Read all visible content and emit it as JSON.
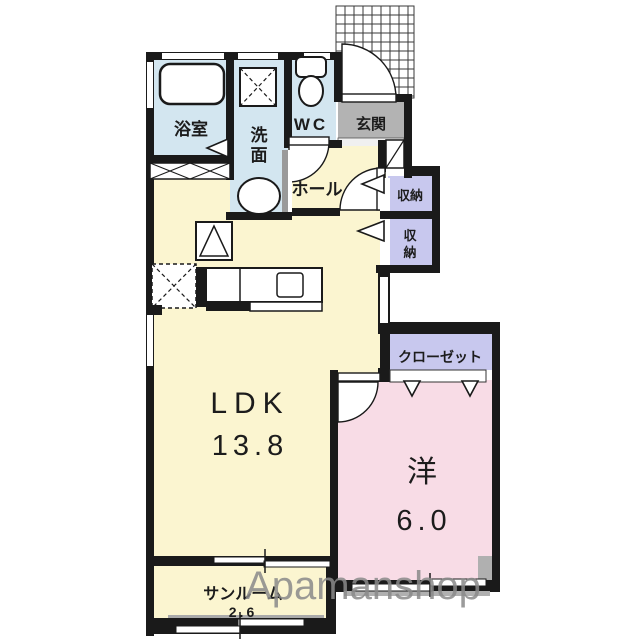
{
  "floorplan": {
    "rooms": {
      "bathroom": {
        "label": "浴室"
      },
      "washroom": {
        "char1": "洗",
        "char2": "面"
      },
      "wc": {
        "label": "WC"
      },
      "genkan": {
        "label": "玄関"
      },
      "hall": {
        "label": "ホール"
      },
      "storage_upper": {
        "label": "収納"
      },
      "storage_lower": {
        "char1": "収",
        "char2": "納"
      },
      "closet": {
        "label": "クローゼット"
      },
      "ldk": {
        "label": "LDK",
        "size": "13.8"
      },
      "western": {
        "label": "洋",
        "size": "6.0"
      },
      "sunroom": {
        "label": "サンルーム",
        "size": "2.6"
      }
    },
    "icons": [
      "bathtub-icon",
      "washing-machine-icon",
      "toilet-icon",
      "sink-icon",
      "refrigerator-icon",
      "kitchen-counter",
      "laundry-space-icon",
      "shoe-cabinet-icon",
      "porch-grid"
    ],
    "watermark": "Apamanshop",
    "colors": {
      "wall": "#1a1a1a",
      "wet_blue": "#d3e6f0",
      "cream": "#fbf5d0",
      "pink": "#f8dce6",
      "lavender": "#c8c8ee",
      "genkan_gray": "#b3b3b3",
      "step_white": "#f0f0f0",
      "shutter_gray": "#b0b0b0",
      "watermark_gray": "#8a8a8a"
    }
  }
}
